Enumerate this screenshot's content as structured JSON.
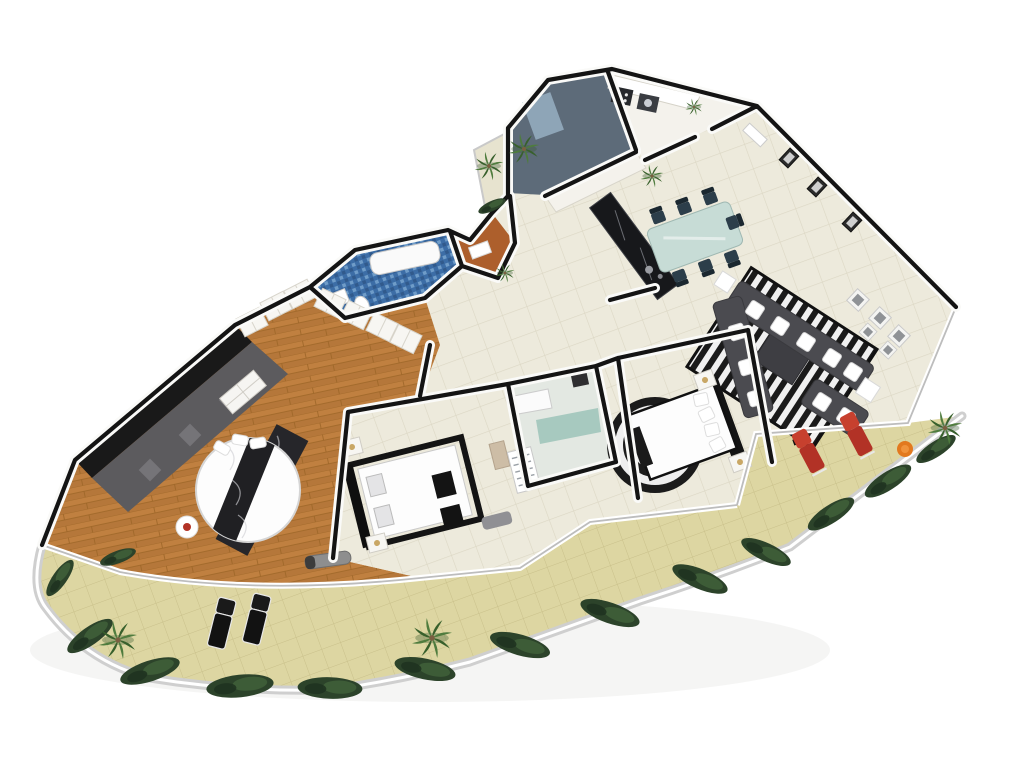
{
  "scene": {
    "description": "aerial 3d rendered apartment floor plan on white background",
    "background": "#ffffff",
    "canvas": {
      "width": 1024,
      "height": 768
    }
  },
  "palette": {
    "background": "#ffffff",
    "wall_black": "#141414",
    "wall_white": "#fafaf8",
    "glass_rail": "#bdbdbd",
    "tile_floor": "#edeadc",
    "tile_line": "#dcd7c4",
    "balcony_tile": "#ddd6a2",
    "balcony_line": "#c9c08a",
    "railing": "#cfcfcf",
    "wood": "#c08040",
    "wood_dark": "#9c6527",
    "master_wall": "#191919",
    "master_rug": "#5c5b5e",
    "master_rug_light": "#8b8a8e",
    "blue_bath": "#3c6da6",
    "blue_bath_light": "#6f9cc8",
    "blue_bath_dark": "#315a8c",
    "orange_panel": "#ad5f2c",
    "shower_floor": "#e3e8e2",
    "teal_glass": "#9cc3b8",
    "utility_floor": "#5d6b79",
    "cabinet_white": "#f4f2ec",
    "counter_dark": "#17181b",
    "sofa_gray": "#4b4b50",
    "ottoman_gray": "#3e3e43",
    "rug_black": "#1a1a1a",
    "rug_white": "#f0f0f0",
    "bed_white": "#fdfdfd",
    "bed_frame": "#141414",
    "table_glass": "#c7dcd6",
    "dining_chair": "#2c3e4a",
    "red_chair": "#b23226",
    "orange_item": "#e2791f",
    "hedge_green": "#2c432a",
    "hedge_light": "#41603a",
    "palm_green": "#4f7c3e",
    "palm_dark": "#38602c",
    "trunk_brown": "#7a5f41",
    "bench_gray": "#909094",
    "shadow": "#e2e2e0"
  },
  "rooms": [
    {
      "id": "master-bedroom",
      "floor": "wood"
    },
    {
      "id": "walk-in-closet",
      "floor": "wood"
    },
    {
      "id": "bathroom-blue-mosaic",
      "floor": "blue_mosaic"
    },
    {
      "id": "bathroom-orange",
      "floor": "orange_panel"
    },
    {
      "id": "shower-bathroom",
      "floor": "pale_tile"
    },
    {
      "id": "bedroom-1",
      "floor": "cream_tile"
    },
    {
      "id": "bedroom-2",
      "floor": "cream_tile"
    },
    {
      "id": "hallway",
      "floor": "cream_tile"
    },
    {
      "id": "kitchen",
      "floor": "cream_tile"
    },
    {
      "id": "dining-area",
      "floor": "cream_tile"
    },
    {
      "id": "entry-hall",
      "floor": "cream_tile"
    },
    {
      "id": "utility-room",
      "floor": "slate"
    },
    {
      "id": "laundry-kitchenette",
      "floor": "white"
    },
    {
      "id": "plant-balcony",
      "floor": "pale_tile"
    },
    {
      "id": "wraparound-terrace",
      "floor": "khaki_tile"
    },
    {
      "id": "terrace-right",
      "floor": "khaki_tile"
    }
  ],
  "decor": {
    "hedges": [
      [
        60,
        578,
        -55,
        0.8
      ],
      [
        90,
        636,
        -35,
        1
      ],
      [
        150,
        671,
        -18,
        1.15
      ],
      [
        240,
        686,
        -6,
        1.25
      ],
      [
        330,
        688,
        2,
        1.2
      ],
      [
        425,
        669,
        12,
        1.15
      ],
      [
        520,
        645,
        16,
        1.15
      ],
      [
        610,
        613,
        19,
        1.15
      ],
      [
        700,
        579,
        23,
        1.1
      ],
      [
        766,
        552,
        25,
        1
      ],
      [
        831,
        514,
        -33,
        1
      ],
      [
        888,
        481,
        -33,
        1
      ],
      [
        936,
        449,
        -33,
        0.85
      ],
      [
        118,
        557,
        -20,
        0.7
      ],
      [
        492,
        206,
        -25,
        0.55
      ]
    ],
    "palms": [
      [
        118,
        640,
        0,
        1
      ],
      [
        432,
        638,
        0,
        1.05
      ],
      [
        945,
        428,
        0,
        0.9
      ],
      [
        489,
        166,
        0,
        0.75
      ],
      [
        524,
        149,
        0,
        0.8
      ],
      [
        652,
        176,
        0,
        0.6
      ],
      [
        505,
        273,
        0,
        0.5
      ],
      [
        694,
        107,
        0,
        0.45
      ]
    ],
    "dining_chairs": [
      [
        658,
        216,
        -20,
        1
      ],
      [
        684,
        207,
        -20,
        1
      ],
      [
        710,
        197,
        -20,
        1
      ],
      [
        680,
        277,
        160,
        1
      ],
      [
        706,
        267,
        160,
        1
      ],
      [
        732,
        258,
        160,
        1
      ],
      [
        734,
        222,
        70,
        1
      ]
    ],
    "sofa_cushions": [
      [
        755,
        310,
        33,
        1
      ],
      [
        780,
        326,
        33,
        1
      ],
      [
        806,
        342,
        33,
        1
      ],
      [
        832,
        358,
        33,
        1
      ],
      [
        853,
        372,
        33,
        1
      ],
      [
        737,
        332,
        74,
        1
      ],
      [
        747,
        367,
        74,
        1
      ],
      [
        756,
        398,
        74,
        1
      ],
      [
        822,
        402,
        33,
        1
      ],
      [
        846,
        417,
        33,
        1
      ]
    ],
    "frames_dark": [
      [
        789,
        158,
        43,
        1
      ],
      [
        817,
        187,
        43,
        1
      ],
      [
        852,
        222,
        43,
        1
      ]
    ],
    "frames_light": [
      [
        858,
        300,
        43,
        1
      ],
      [
        880,
        318,
        43,
        1
      ],
      [
        899,
        336,
        43,
        1
      ],
      [
        868,
        332,
        43,
        0.8
      ],
      [
        888,
        350,
        43,
        0.8
      ]
    ],
    "red_lounges": [
      [
        812,
        458,
        -28,
        1
      ],
      [
        860,
        441,
        -28,
        1
      ]
    ],
    "black_lounges": [
      [
        220,
        630,
        14,
        1
      ],
      [
        255,
        626,
        14,
        1
      ]
    ],
    "wardrobes": [
      [
        252,
        322,
        -27,
        1
      ],
      [
        276,
        306,
        -27,
        1
      ],
      [
        300,
        294,
        -27,
        1
      ],
      [
        330,
        303,
        26,
        1
      ],
      [
        356,
        315,
        26,
        1
      ],
      [
        382,
        327,
        26,
        1
      ],
      [
        406,
        339,
        26,
        1
      ]
    ],
    "nightstands": [
      [
        352,
        447,
        -14,
        1
      ],
      [
        377,
        543,
        -14,
        1
      ],
      [
        705,
        380,
        -20,
        1
      ],
      [
        740,
        462,
        -20,
        1
      ]
    ]
  }
}
